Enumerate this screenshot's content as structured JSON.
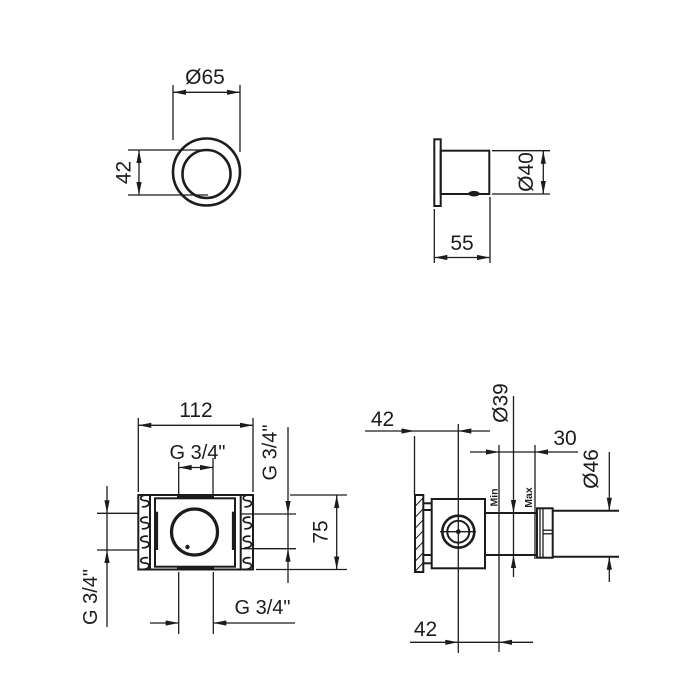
{
  "drawing": {
    "background_color": "#ffffff",
    "line_color": "#1c1c1c",
    "views": {
      "escutcheon_front": {
        "diameter_label": "Ø65",
        "inner_diameter_label": "42"
      },
      "escutcheon_side": {
        "diameter_label": "Ø40",
        "depth_label": "55"
      },
      "box_front": {
        "width_label": "112",
        "height_label": "75",
        "top_port_label": "G 3/4\"",
        "right_port_label": "G 3/4\"",
        "bottom_port_label": "G 3/4\"",
        "left_port_label": "G 3/4\""
      },
      "valve_side": {
        "plate_offset_label": "42",
        "sleeve_diameter_label": "Ø39",
        "adjustment_range_label": "30",
        "handle_diameter_label": "Ø46",
        "min_label": "Min",
        "max_label": "Max",
        "center_offset_label": "42"
      }
    }
  }
}
